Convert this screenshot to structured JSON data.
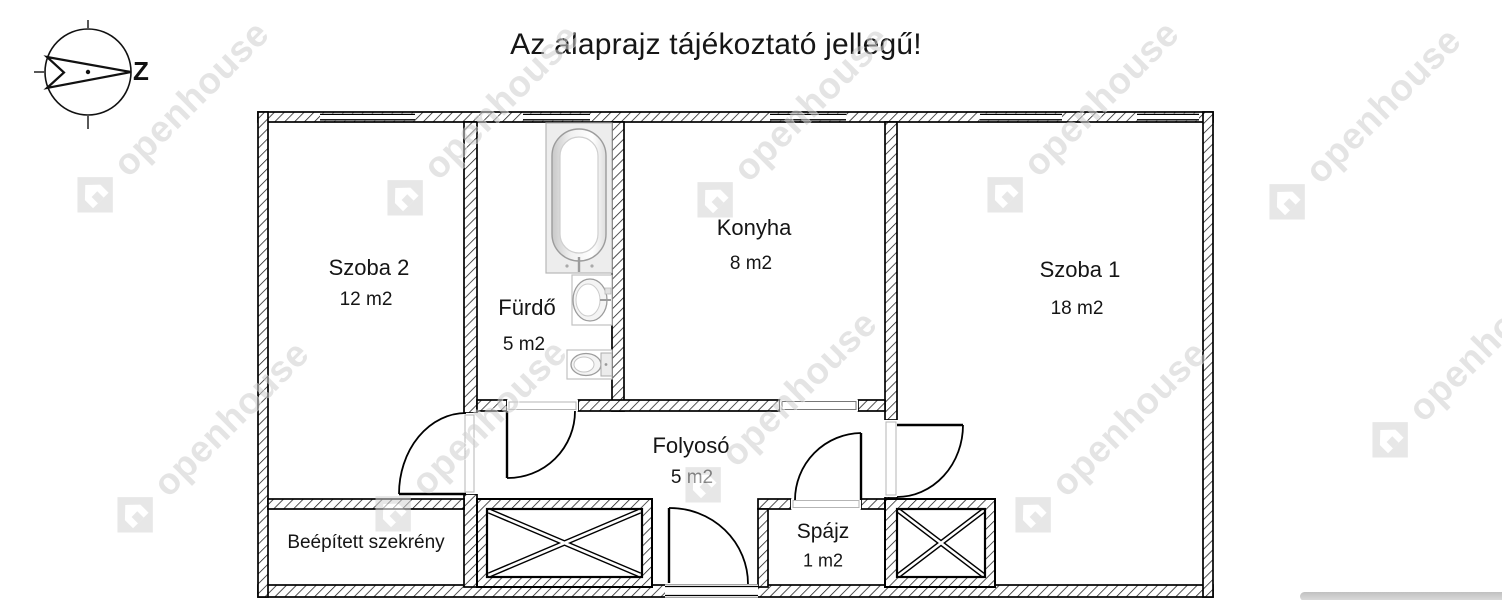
{
  "title": "Az alaprajz tájékoztató jellegű!",
  "compass": {
    "direction_label": "Z"
  },
  "watermark": {
    "text": "openhouse"
  },
  "rooms": {
    "szoba2": {
      "name": "Szoba 2",
      "area": "12 m2"
    },
    "furdo": {
      "name": "Fürdő",
      "area": "5 m2"
    },
    "konyha": {
      "name": "Konyha",
      "area": "8 m2"
    },
    "szoba1": {
      "name": "Szoba 1",
      "area": "18 m2"
    },
    "folyoso": {
      "name": "Folyosó",
      "area": "5 m2"
    },
    "spajz": {
      "name": "Spájz",
      "area": "1 m2"
    },
    "wardrobe": {
      "name": "Beépített szekrény"
    }
  },
  "colors": {
    "line": "#000000",
    "fixture_gray": "#ededed",
    "watermark_gray": "#d2d2d2",
    "bottom_bar": "#c6c6c6"
  }
}
